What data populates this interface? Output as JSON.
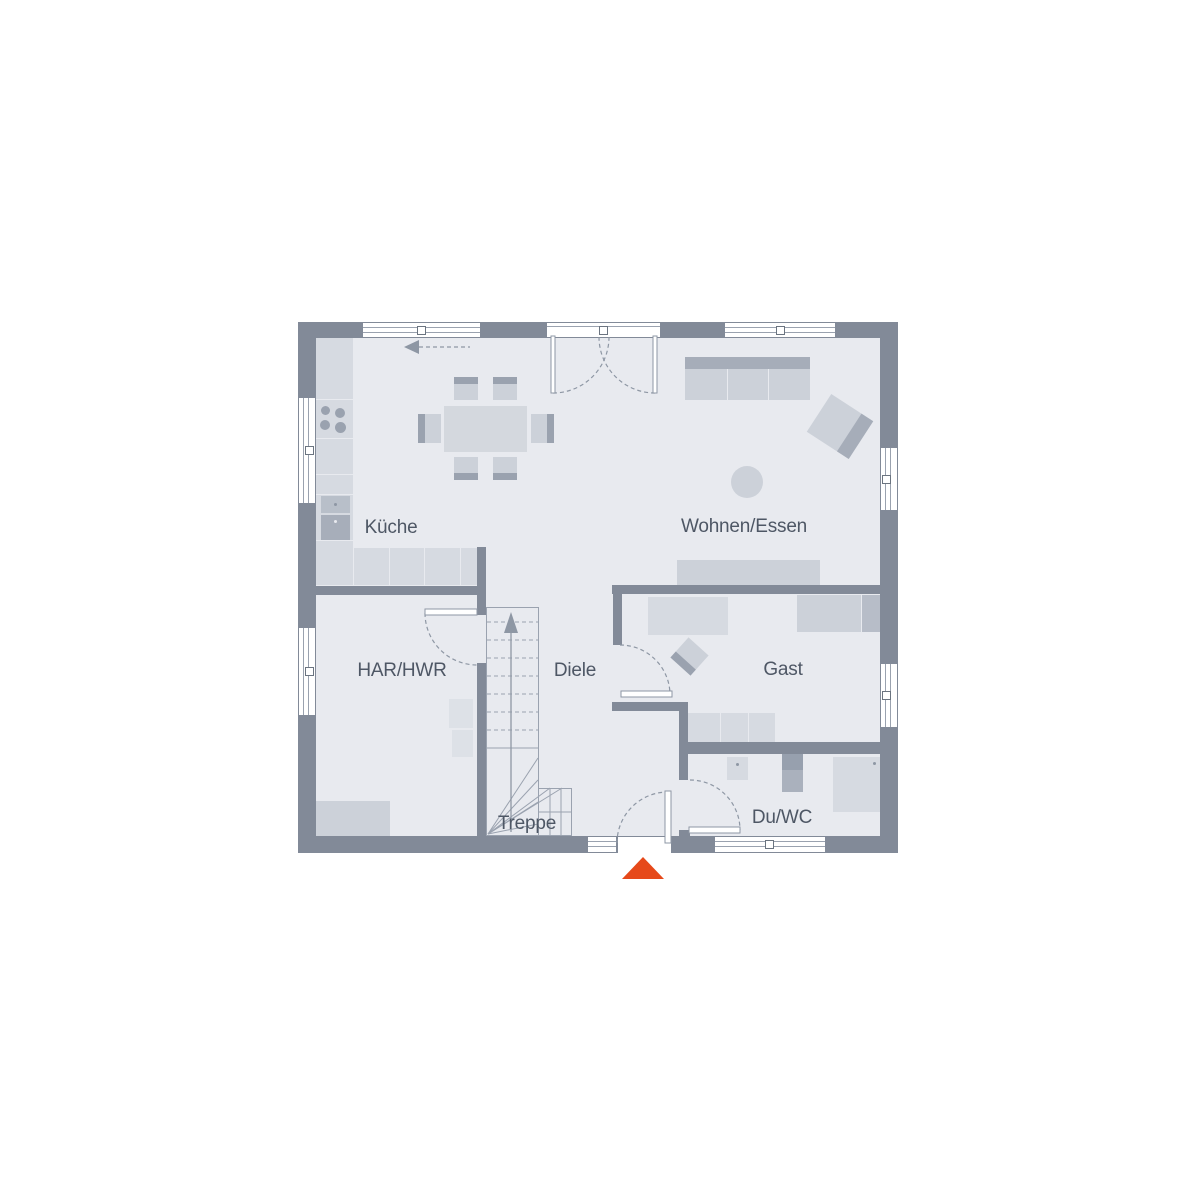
{
  "plan": {
    "type": "floor-plan-ground-floor",
    "rooms": [
      {
        "id": "kueche",
        "label": "Küche"
      },
      {
        "id": "wohnen-essen",
        "label": "Wohnen/Essen"
      },
      {
        "id": "har-hwr",
        "label": "HAR/HWR"
      },
      {
        "id": "diele",
        "label": "Diele"
      },
      {
        "id": "gast",
        "label": "Gast"
      },
      {
        "id": "treppe",
        "label": "Treppe"
      },
      {
        "id": "du-wc",
        "label": "Du/WC"
      }
    ],
    "fixtures": [
      "cooktop",
      "kitchen-sink",
      "oven",
      "kitchen-counter",
      "dining-table",
      "dining-chairs",
      "sofa",
      "armchair",
      "side-table",
      "sideboard",
      "desk",
      "bed",
      "dresser",
      "guest-chair",
      "washer",
      "bathroom-sink",
      "toilet",
      "shower",
      "stairs",
      "entrance-door",
      "terrace-door"
    ],
    "colors": {
      "wall": "#828a98",
      "floor": "#e8eaef",
      "furniture_light": "#d6dae1",
      "furniture_mid": "#ccd1d9",
      "accent_dark": "#9aa2af",
      "line": "#8e97a4",
      "label_text": "#4e5765",
      "entrance_marker": "#e6491a"
    }
  }
}
